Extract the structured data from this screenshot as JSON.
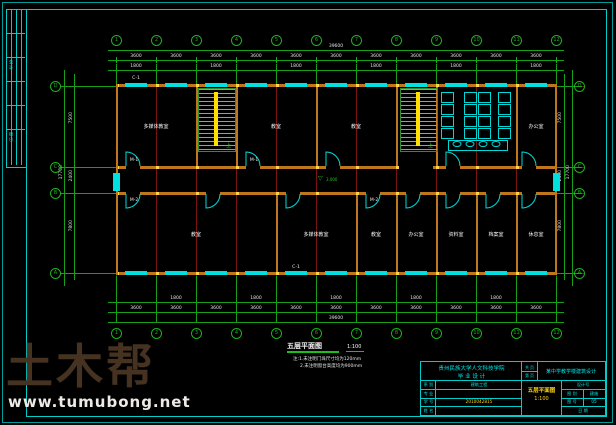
{
  "watermark": {
    "brand": "土木帮",
    "url": "www.tumubong.net"
  },
  "signoff": {
    "texts": [
      "会 签",
      "日 期"
    ]
  },
  "plan": {
    "label": {
      "title": "五层平面图",
      "scale": "1:100"
    },
    "notes": [
      "注:1.未注明门垛尺寸均为120mm",
      "2.未注明窗台高度均为900mm"
    ],
    "elevation": "3.000",
    "stair_up": "上",
    "axes_cols": [
      "1",
      "2",
      "3",
      "4",
      "5",
      "6",
      "7",
      "8",
      "9",
      "10",
      "11",
      "12"
    ],
    "axes_rows": [
      "D",
      "C",
      "B",
      "A"
    ],
    "dims": {
      "bay": "3600",
      "win": "1800",
      "total_width": "39600",
      "depth_top": "7500",
      "corridor": "2400",
      "depth_bottom": "7800",
      "total_height": "17700"
    },
    "rooms_top": [
      "多媒体教室",
      "教室",
      "教室",
      "办公室"
    ],
    "rooms_bottom": [
      "教室",
      "多媒体教室",
      "教室",
      "办公室",
      "资料室",
      "档案室",
      "休息室"
    ],
    "tags": {
      "door1": "M-1",
      "door2": "M-2",
      "window": "C-1"
    }
  },
  "title_block": {
    "school_line1": "贵州民族大学人文科技学院",
    "school_line2": "毕 业 设 计",
    "project": "某中学教学楼建筑设计",
    "pages": [
      "共 页",
      "第 页"
    ],
    "rows": [
      {
        "label": "系 别",
        "value": "建筑工程"
      },
      {
        "label": "专 业",
        "value": ""
      },
      {
        "label": "学 号",
        "value": "2010042815"
      },
      {
        "label": "姓 名",
        "value": ""
      }
    ],
    "drawing_title": "五层平面图",
    "drawing_scale": "1:100",
    "right_rows": [
      {
        "label": "设计号",
        "value": ""
      },
      {
        "label": "图 别",
        "value": "建施"
      },
      {
        "label": "图 号",
        "value": "05"
      },
      {
        "label": "日 期",
        "value": ""
      }
    ]
  }
}
